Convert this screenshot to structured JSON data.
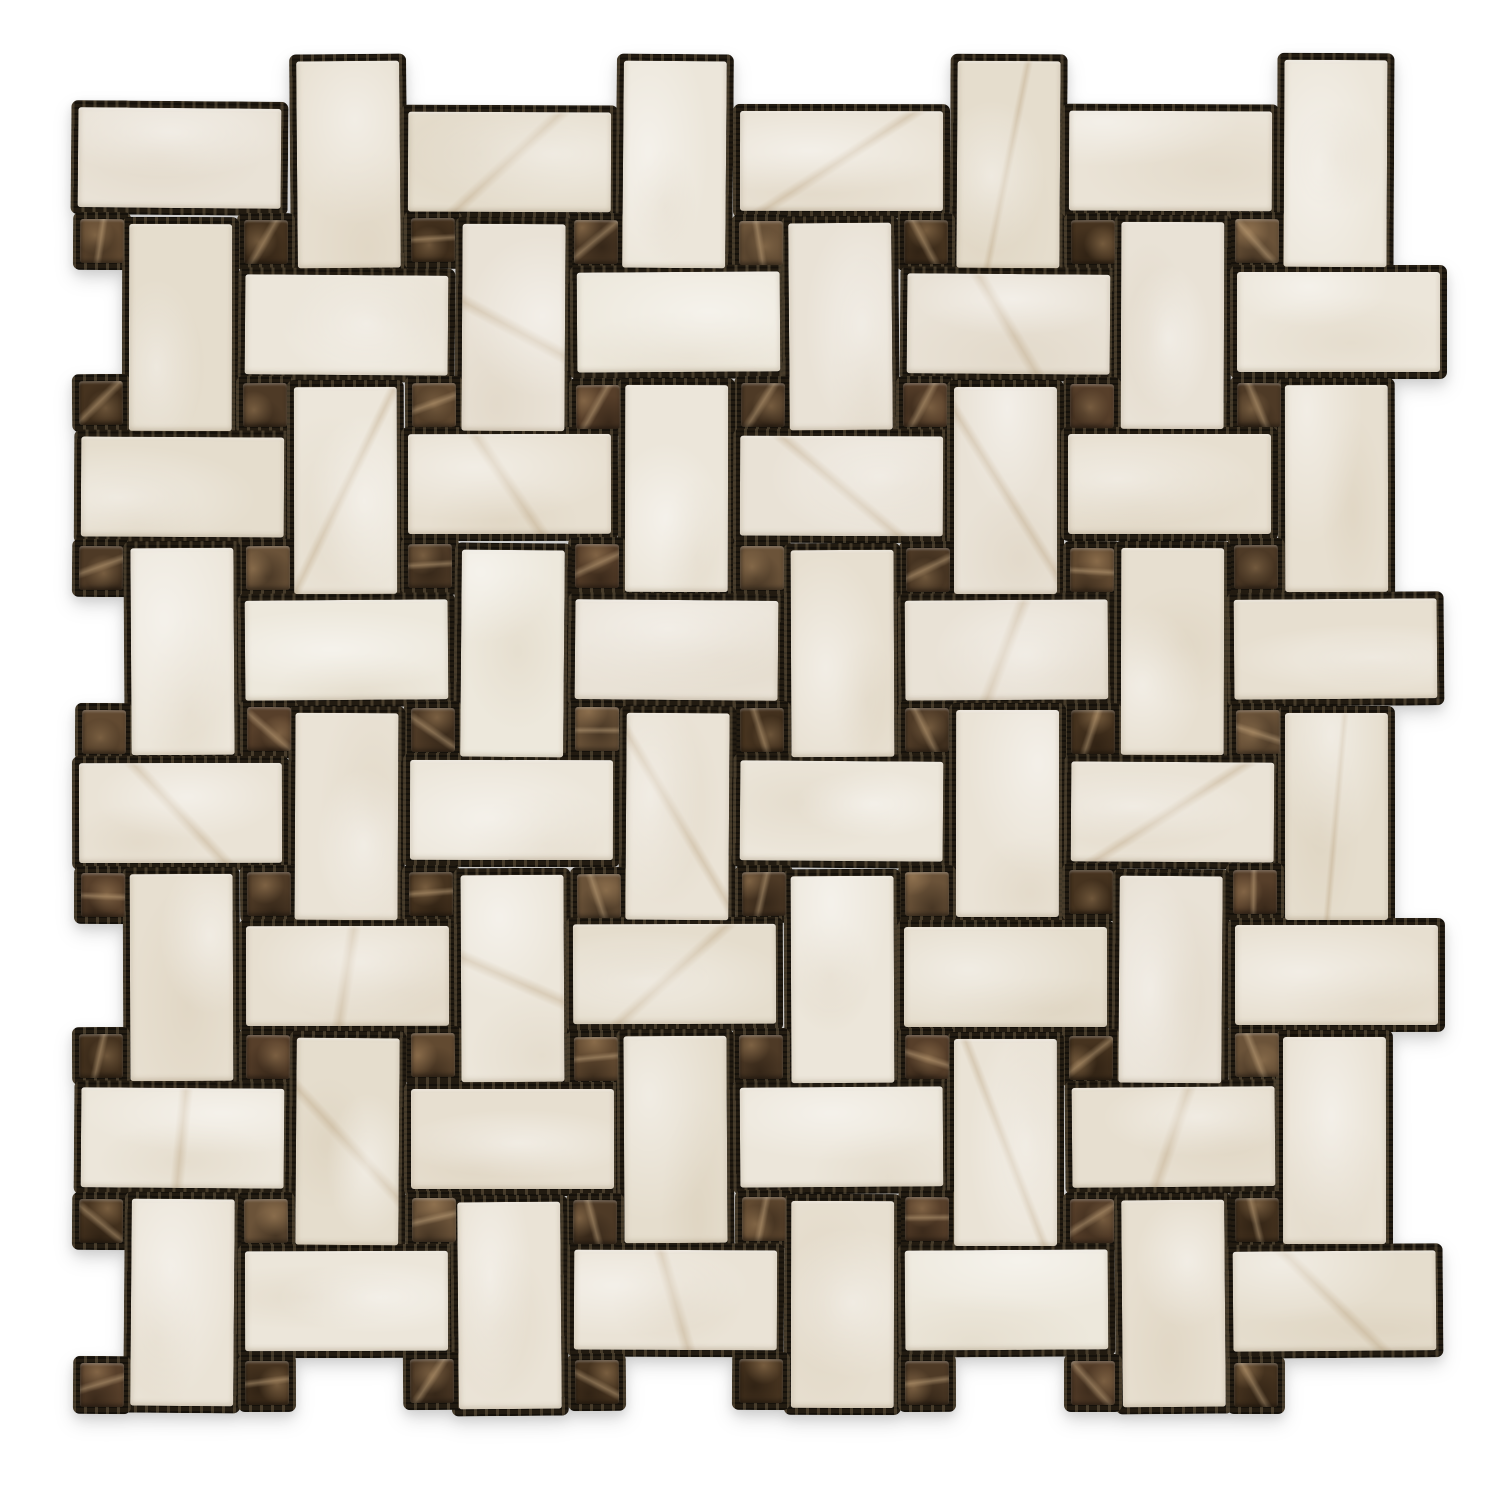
{
  "image": {
    "type": "product-photo",
    "subject": "Stone mosaic tile sheet, basketweave pattern with dots",
    "field_material": "cream beige marble rectangles",
    "dot_material": "dark emperador brown marble squares",
    "background_color": "#ffffff"
  },
  "mosaic": {
    "grid": {
      "cols": 8,
      "rows": 8,
      "origin_x": 80,
      "origin_y": 110,
      "cell_w": 165,
      "cell_h": 163
    },
    "pieces": {
      "horizontal_rect": {
        "w": 203,
        "h": 100,
        "dx": 0,
        "dy": 0,
        "count": 32
      },
      "vertical_rect": {
        "w": 103,
        "h": 207,
        "dx": 50,
        "dy": -50,
        "count": 32
      },
      "dot": {
        "w": 44,
        "h": 44,
        "dx": 0,
        "dy": 110,
        "count": 64
      }
    },
    "grout": {
      "color": "#221b11",
      "mesh_fleck": "rgba(158,138,104,0.30)",
      "mesh_dark": "rgba(0,0,0,0.38)",
      "expand": 7
    },
    "cream_colors": [
      "#eae3d6",
      "#e7dfd0",
      "#ece6da",
      "#e5ddcd",
      "#e9e2d6",
      "#ede8dc"
    ],
    "cream_highlight": "rgba(255,255,255,0.45)",
    "cream_mottle": "rgba(193,174,142,0.16)",
    "cream_vein": "rgba(168,138,96,0.28)",
    "dot_colors": [
      "#4e3a26",
      "#573f2a",
      "#624a31",
      "#46331f",
      "#6b5339"
    ],
    "dot_vein": "rgba(205,176,136,0.45)",
    "dot_glint": "rgba(196,158,112,0.40)",
    "dot_shade": "rgba(14,8,3,0.38)",
    "jitter": {
      "pos": 2,
      "rot": 0.5
    }
  }
}
